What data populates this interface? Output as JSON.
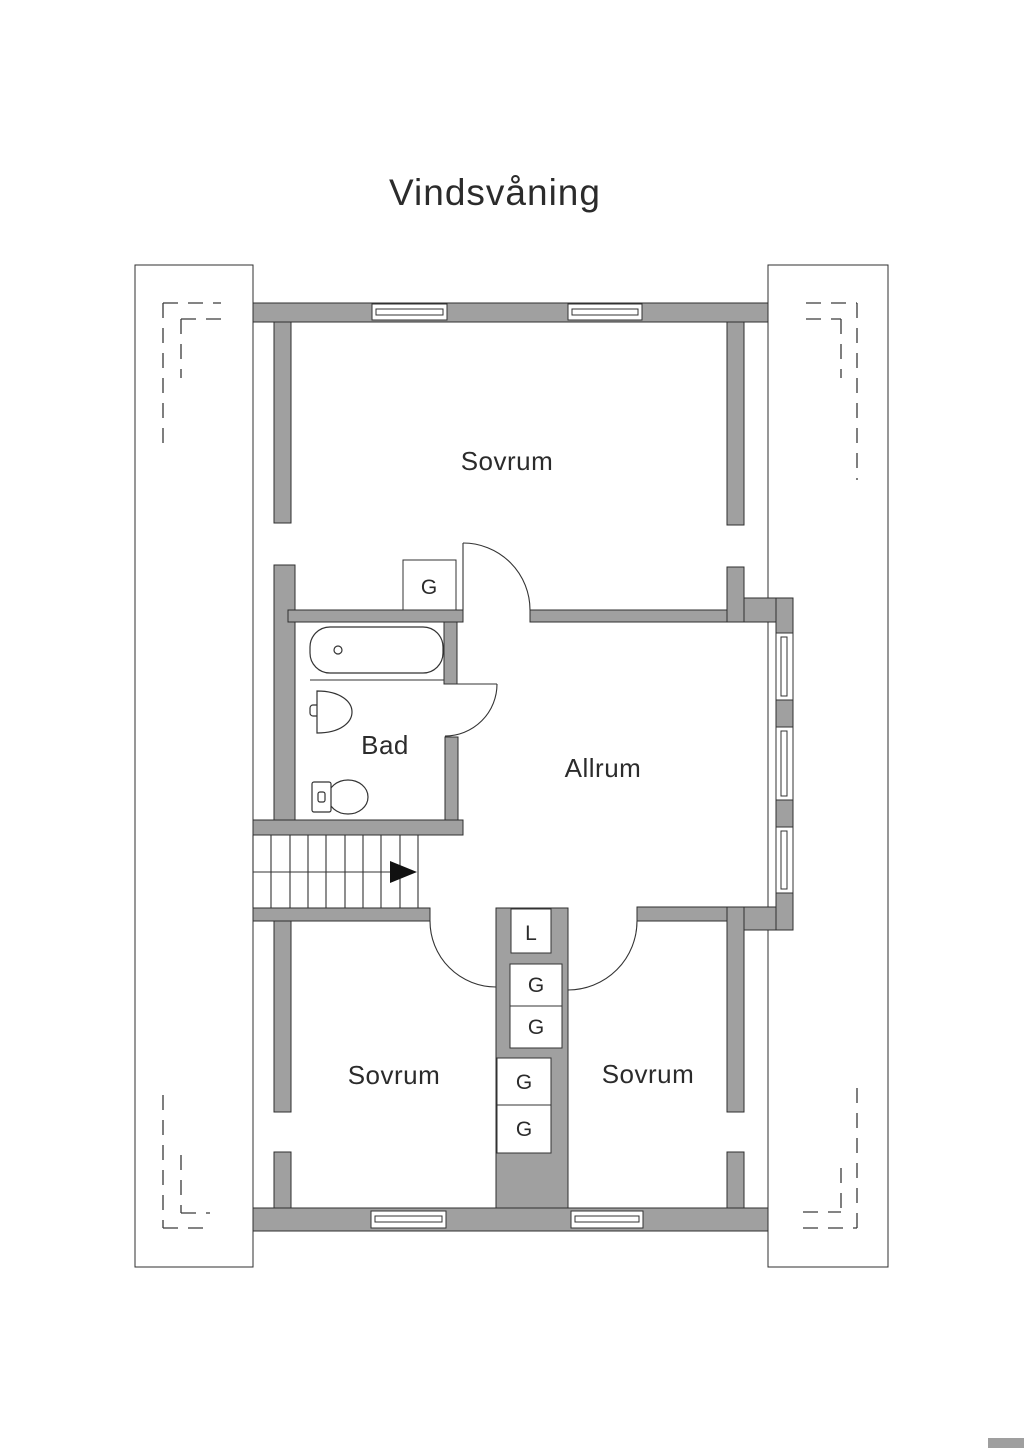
{
  "title": "Vindsvåning",
  "rooms": {
    "sovrum_top": "Sovrum",
    "bad": "Bad",
    "allrum": "Allrum",
    "sovrum_bottom_left": "Sovrum",
    "sovrum_bottom_right": "Sovrum"
  },
  "closets": {
    "top_g": "G",
    "linen": "L",
    "g1": "G",
    "g2": "G",
    "g3": "G",
    "g4": "G"
  },
  "colors": {
    "wall": "#a0a0a0",
    "wall_outline": "#2f2f2f",
    "line": "#333333",
    "text": "#2b2b2b",
    "dash": "#3a3a3a",
    "background": "#ffffff"
  }
}
